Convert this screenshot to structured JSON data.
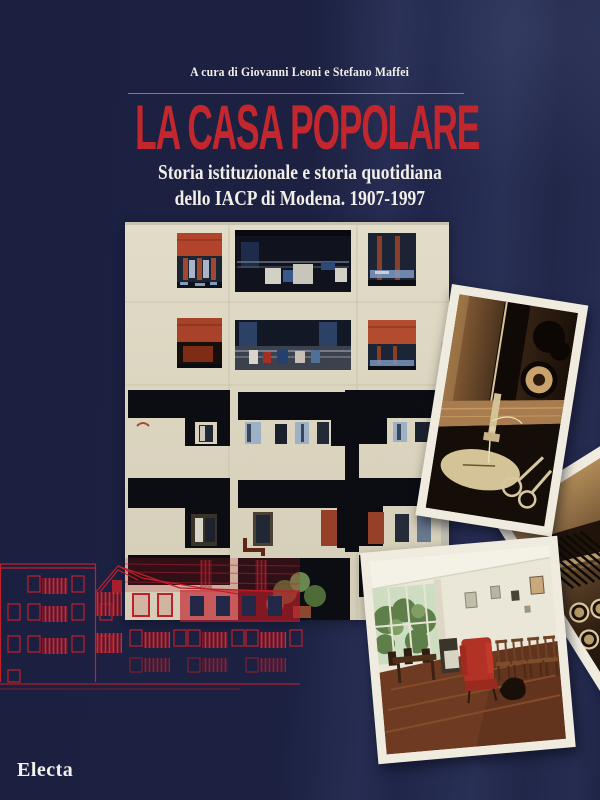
{
  "book_cover": {
    "author_line": "A cura di Giovanni Leoni e Stefano Maffei",
    "title": "LA CASA POPOLARE",
    "subtitle_line1": "Storia istituzionale e storia quotidiana",
    "subtitle_line2": "dello IACP di Modena. 1907-1997",
    "publisher": "Electa"
  },
  "colors": {
    "cover_navy": "#1e2345",
    "title_red": "#c4262e",
    "text_white": "#f2efe8",
    "facade_cream": "#ddd6c2",
    "awning_red": "#b1442a",
    "elevation_red": "#c11f2a",
    "polaroid_border": "#f0ebdf"
  },
  "images": {
    "building_photo": "apartment building facade with balconies and red awnings",
    "sewing_photo": "sepia close-up of a sewing machine with scissors",
    "typewriter_photo": "sepia close-up of typewriter keys",
    "interior_photo": "common-room interior with red armchair and wooden chairs",
    "elevation_drawing": "red architectural elevation line drawing of row houses"
  }
}
